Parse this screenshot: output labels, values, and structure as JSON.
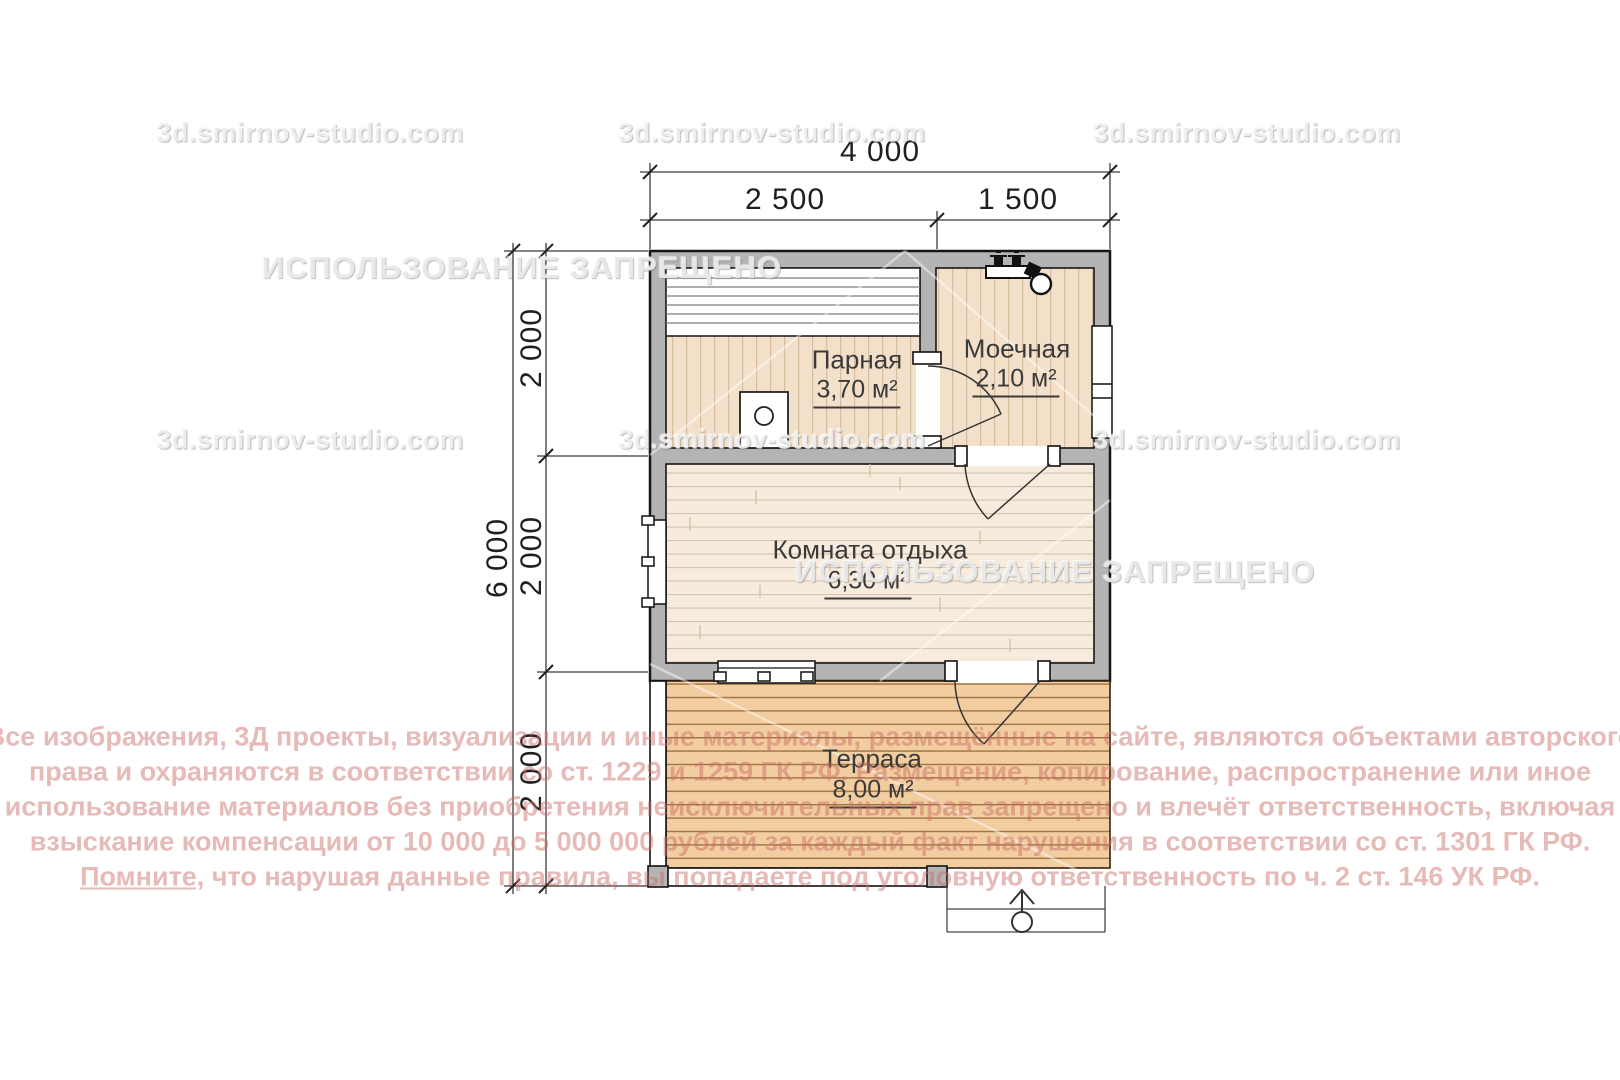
{
  "plan": {
    "rooms": [
      {
        "name": "Парная",
        "area": "3,70 м²"
      },
      {
        "name": "Моечная",
        "area": "2,10 м²"
      },
      {
        "name": "Комната отдыха",
        "area": "6,30 м²"
      },
      {
        "name": "Терраса",
        "area": "8,00 м²"
      }
    ],
    "dimensions": {
      "width_total": "4 000",
      "width_segments": [
        "2 500",
        "1 500"
      ],
      "height_total": "6 000",
      "height_segments": [
        "2 000",
        "2 000",
        "2 000"
      ]
    }
  },
  "watermarks": {
    "site": "3d.smirnov-studio.com",
    "ban": "ИСПОЛЬЗОВАНИЕ ЗАПРЕЩЕНО"
  },
  "copyright": {
    "lines": [
      "Все изображения, 3Д проекты, визуализации и иные материалы, размещённые на сайте, являются объектами авторского",
      "права и охраняются в соответствии со ст. 1229 и 1259 ГК РФ. Размещение, копирование, распространение или иное",
      "использование материалов без приобретения неисключительных прав запрещено и влечёт ответственность, включая",
      "взыскание компенсации от 10 000 до 5 000 000 рублей за каждый факт нарушения в соответствии со ст. 1301 ГК РФ."
    ],
    "last_line_underlined": "Помните,",
    "last_line_rest": " что нарушая данные правила, вы попадаете под уголовную ответственность по ч. 2 ст. 146 УК РФ."
  },
  "colors": {
    "wall": "#b4b4b4",
    "sauna_floor": "#f2e0cb",
    "lounge_floor": "#f6ebdc",
    "terrace_floor": "#f2cda0",
    "copyright_text": "#e6b9b7"
  }
}
